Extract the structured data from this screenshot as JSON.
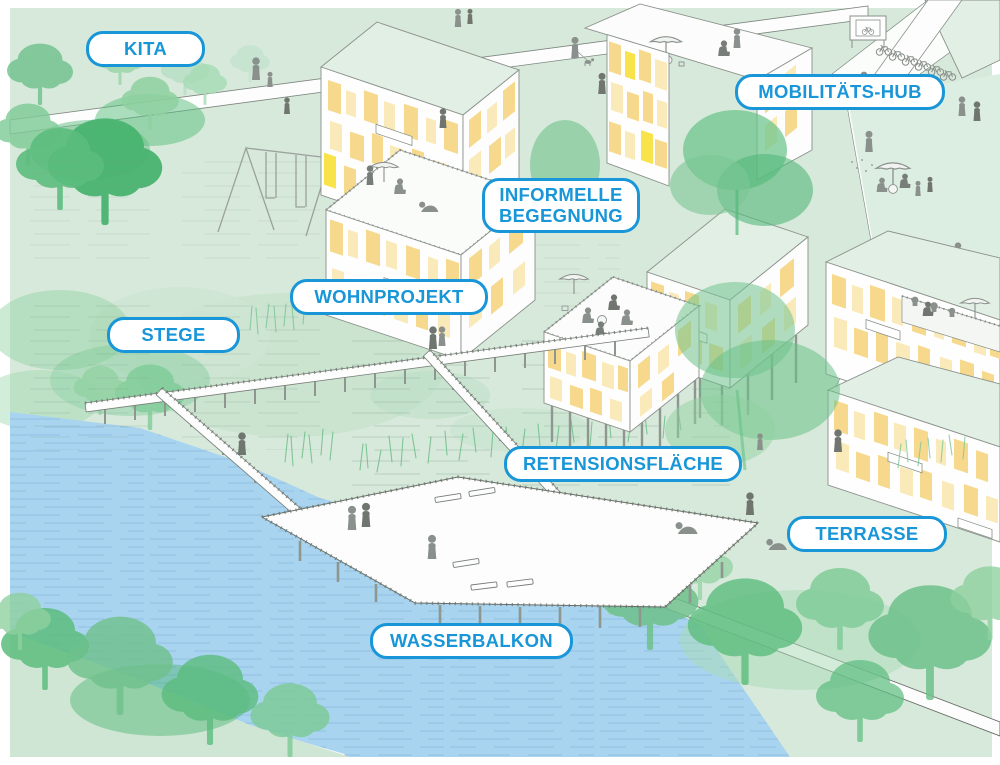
{
  "labels": [
    {
      "id": "kita",
      "text": "KITA"
    },
    {
      "id": "mobilitaets-hub",
      "text": "MOBILITÄTS-HUB"
    },
    {
      "id": "informelle-begegnung",
      "text": "INFORMELLE BEGEGNUNG"
    },
    {
      "id": "wohnprojekt",
      "text": "WOHNPROJEKT"
    },
    {
      "id": "stege",
      "text": "STEGE"
    },
    {
      "id": "retensionsflaeche",
      "text": "RETENSIONSFLÄCHE"
    },
    {
      "id": "terrasse",
      "text": "TERRASSE"
    },
    {
      "id": "wasserbalkon",
      "text": "WASSERBALKON"
    }
  ],
  "colors": {
    "accent_blue": "#1896d8",
    "label_bg": "#ffffff",
    "bg_green": "#d7e9da",
    "water_blue": "#a9d4ef",
    "roof_mint": "#e2efe5",
    "window_amber": "#f7d98d",
    "window_pale": "#fbeab9",
    "window_yellow": "#f8e34a",
    "tree_green": "#6ec18b",
    "tree_dark": "#4fb873",
    "person_gray": "#8a908c",
    "line_gray": "#7d8680"
  }
}
